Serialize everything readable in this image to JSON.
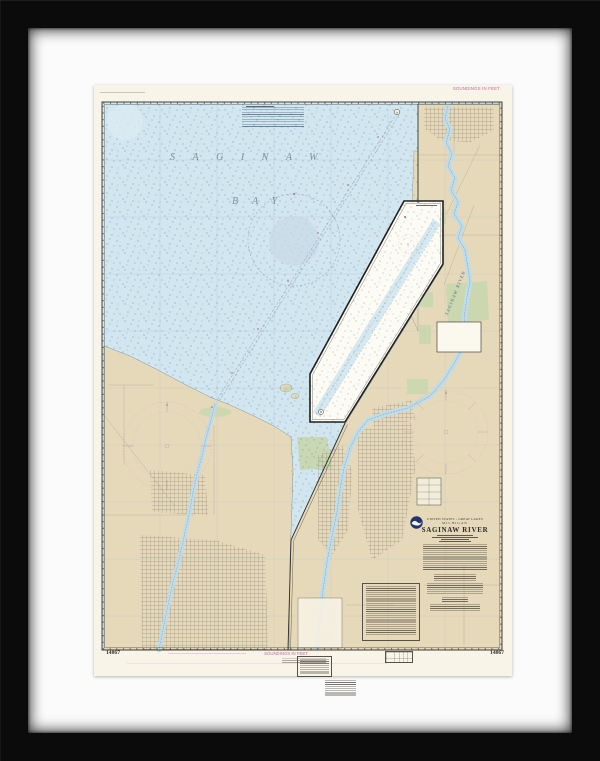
{
  "artwork": {
    "kind": "framed NOAA nautical chart print",
    "frame_color": "#0b0b0b",
    "mat_color": "#fbfbfb"
  },
  "chart": {
    "number_bottom_left": "14867",
    "number_bottom_right": "14867",
    "soundings_note_top": "SOUNDINGS IN FEET",
    "soundings_note_bottom": "SOUNDINGS IN FEET",
    "bay_word_1": "SAGINAW",
    "bay_word_2": "BAY",
    "river_label": "SAGINAW RIVER",
    "title_block": {
      "country_line": "UNITED STATES - GREAT LAKES",
      "state_line": "MICHIGAN",
      "title": "SAGINAW RIVER"
    },
    "inset_marker_a": "A",
    "inset_marker_b": "B",
    "colors": {
      "water": "#d2e6f0",
      "land": "#e6d9ba",
      "park_green": "#c9d7ae",
      "magenta_accent": "#c1699c",
      "paper": "#f8f4e8"
    }
  }
}
